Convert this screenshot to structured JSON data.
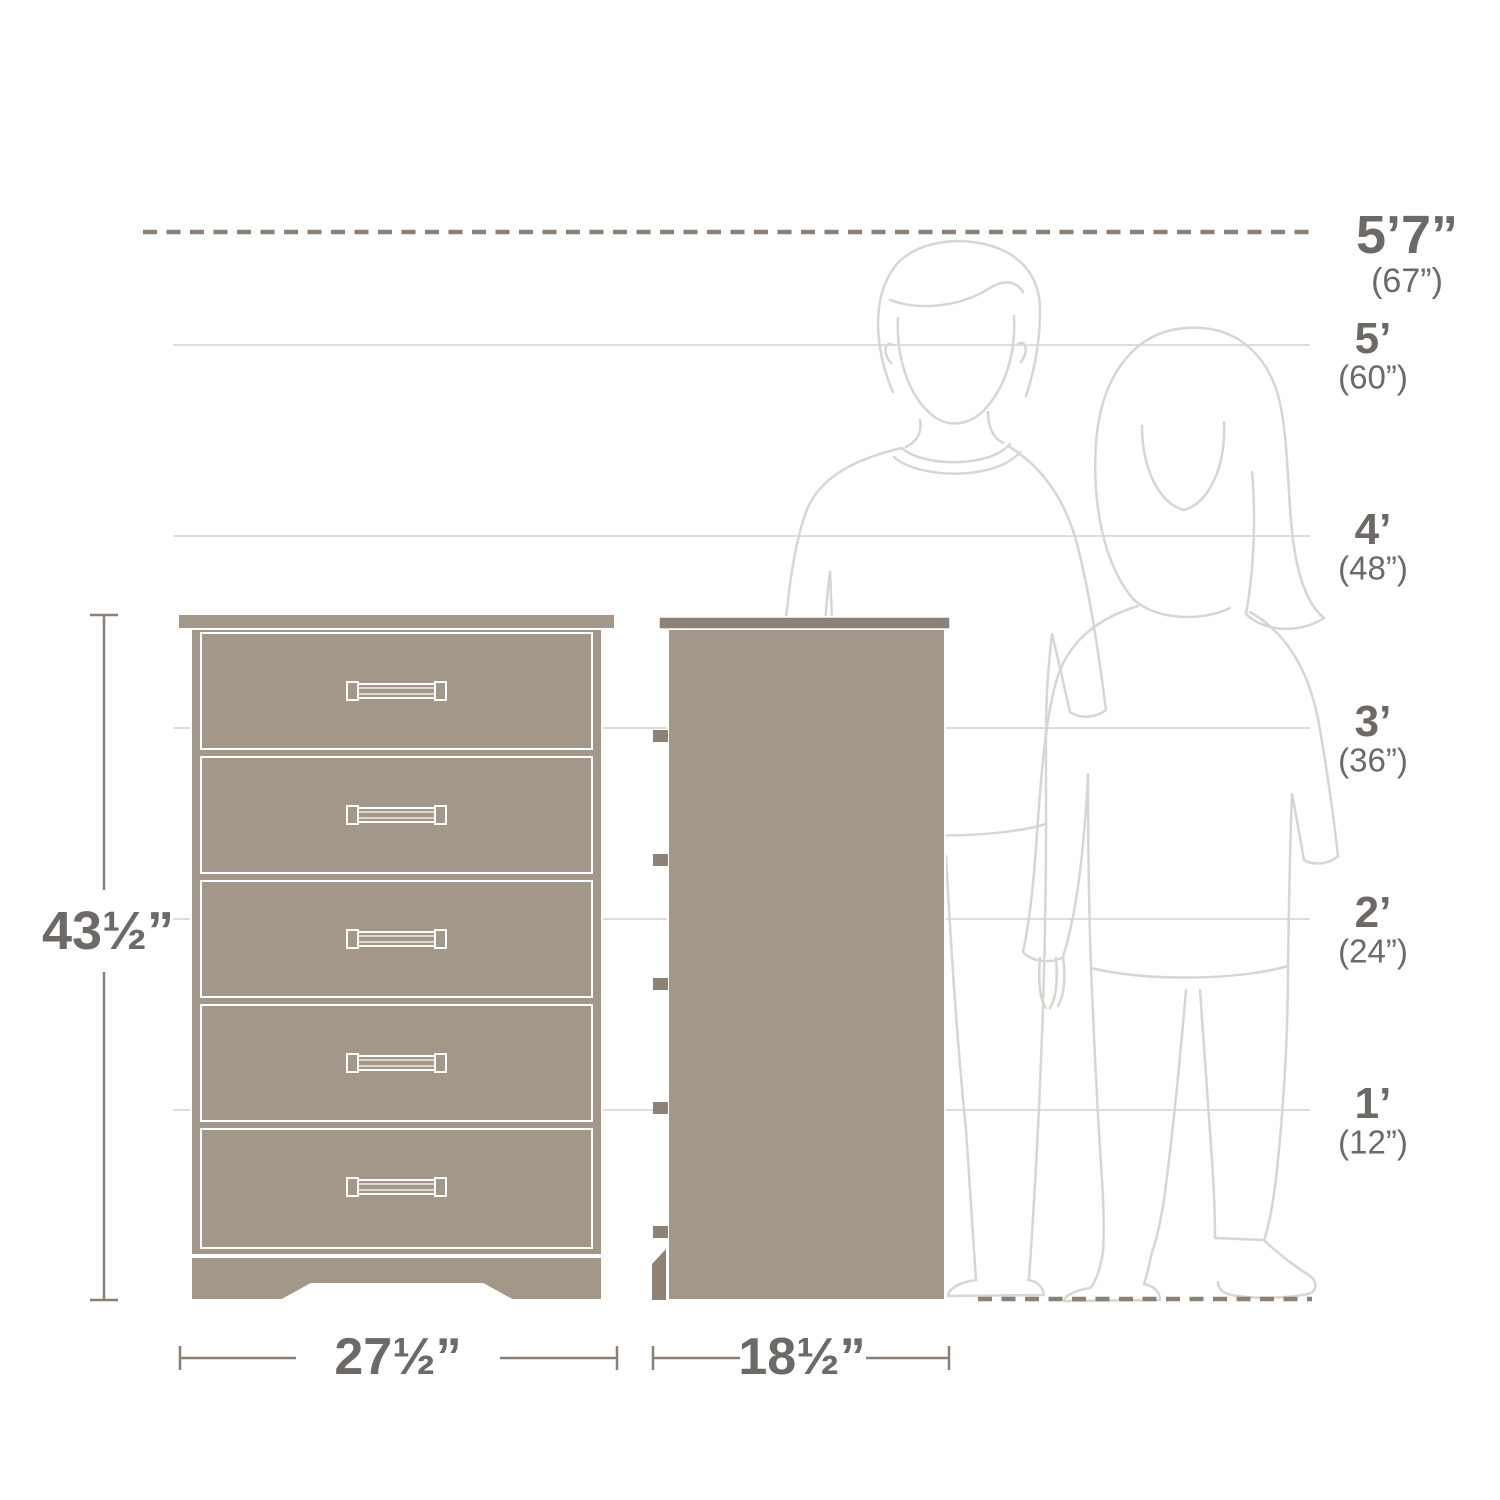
{
  "page": {
    "background": "#ffffff"
  },
  "colors": {
    "dresser_fill": "#a39789",
    "dresser_dark": "#8d8275",
    "outline_white": "#ffffff",
    "figure_line": "#d9d5d1",
    "ref_line": "#dfdcd9",
    "dash_line": "#8a8077",
    "dim_line": "#8a8077",
    "text_color": "#6c6966"
  },
  "height_scale": {
    "markers": [
      {
        "feet": "5’7”",
        "inches": "(67”)"
      },
      {
        "feet": "5’",
        "inches": "(60”)"
      },
      {
        "feet": "4’",
        "inches": "(48”)"
      },
      {
        "feet": "3’",
        "inches": "(36”)"
      },
      {
        "feet": "2’",
        "inches": "(24”)"
      },
      {
        "feet": "1’",
        "inches": "(12”)"
      }
    ]
  },
  "dimensions": {
    "height": "43½”",
    "width": "27½”",
    "depth": "18½”"
  },
  "furniture": {
    "type": "5-drawer chest",
    "drawer_count": 5,
    "views": [
      "front",
      "side"
    ]
  },
  "figures": {
    "left": "man outline",
    "right": "woman outline"
  }
}
